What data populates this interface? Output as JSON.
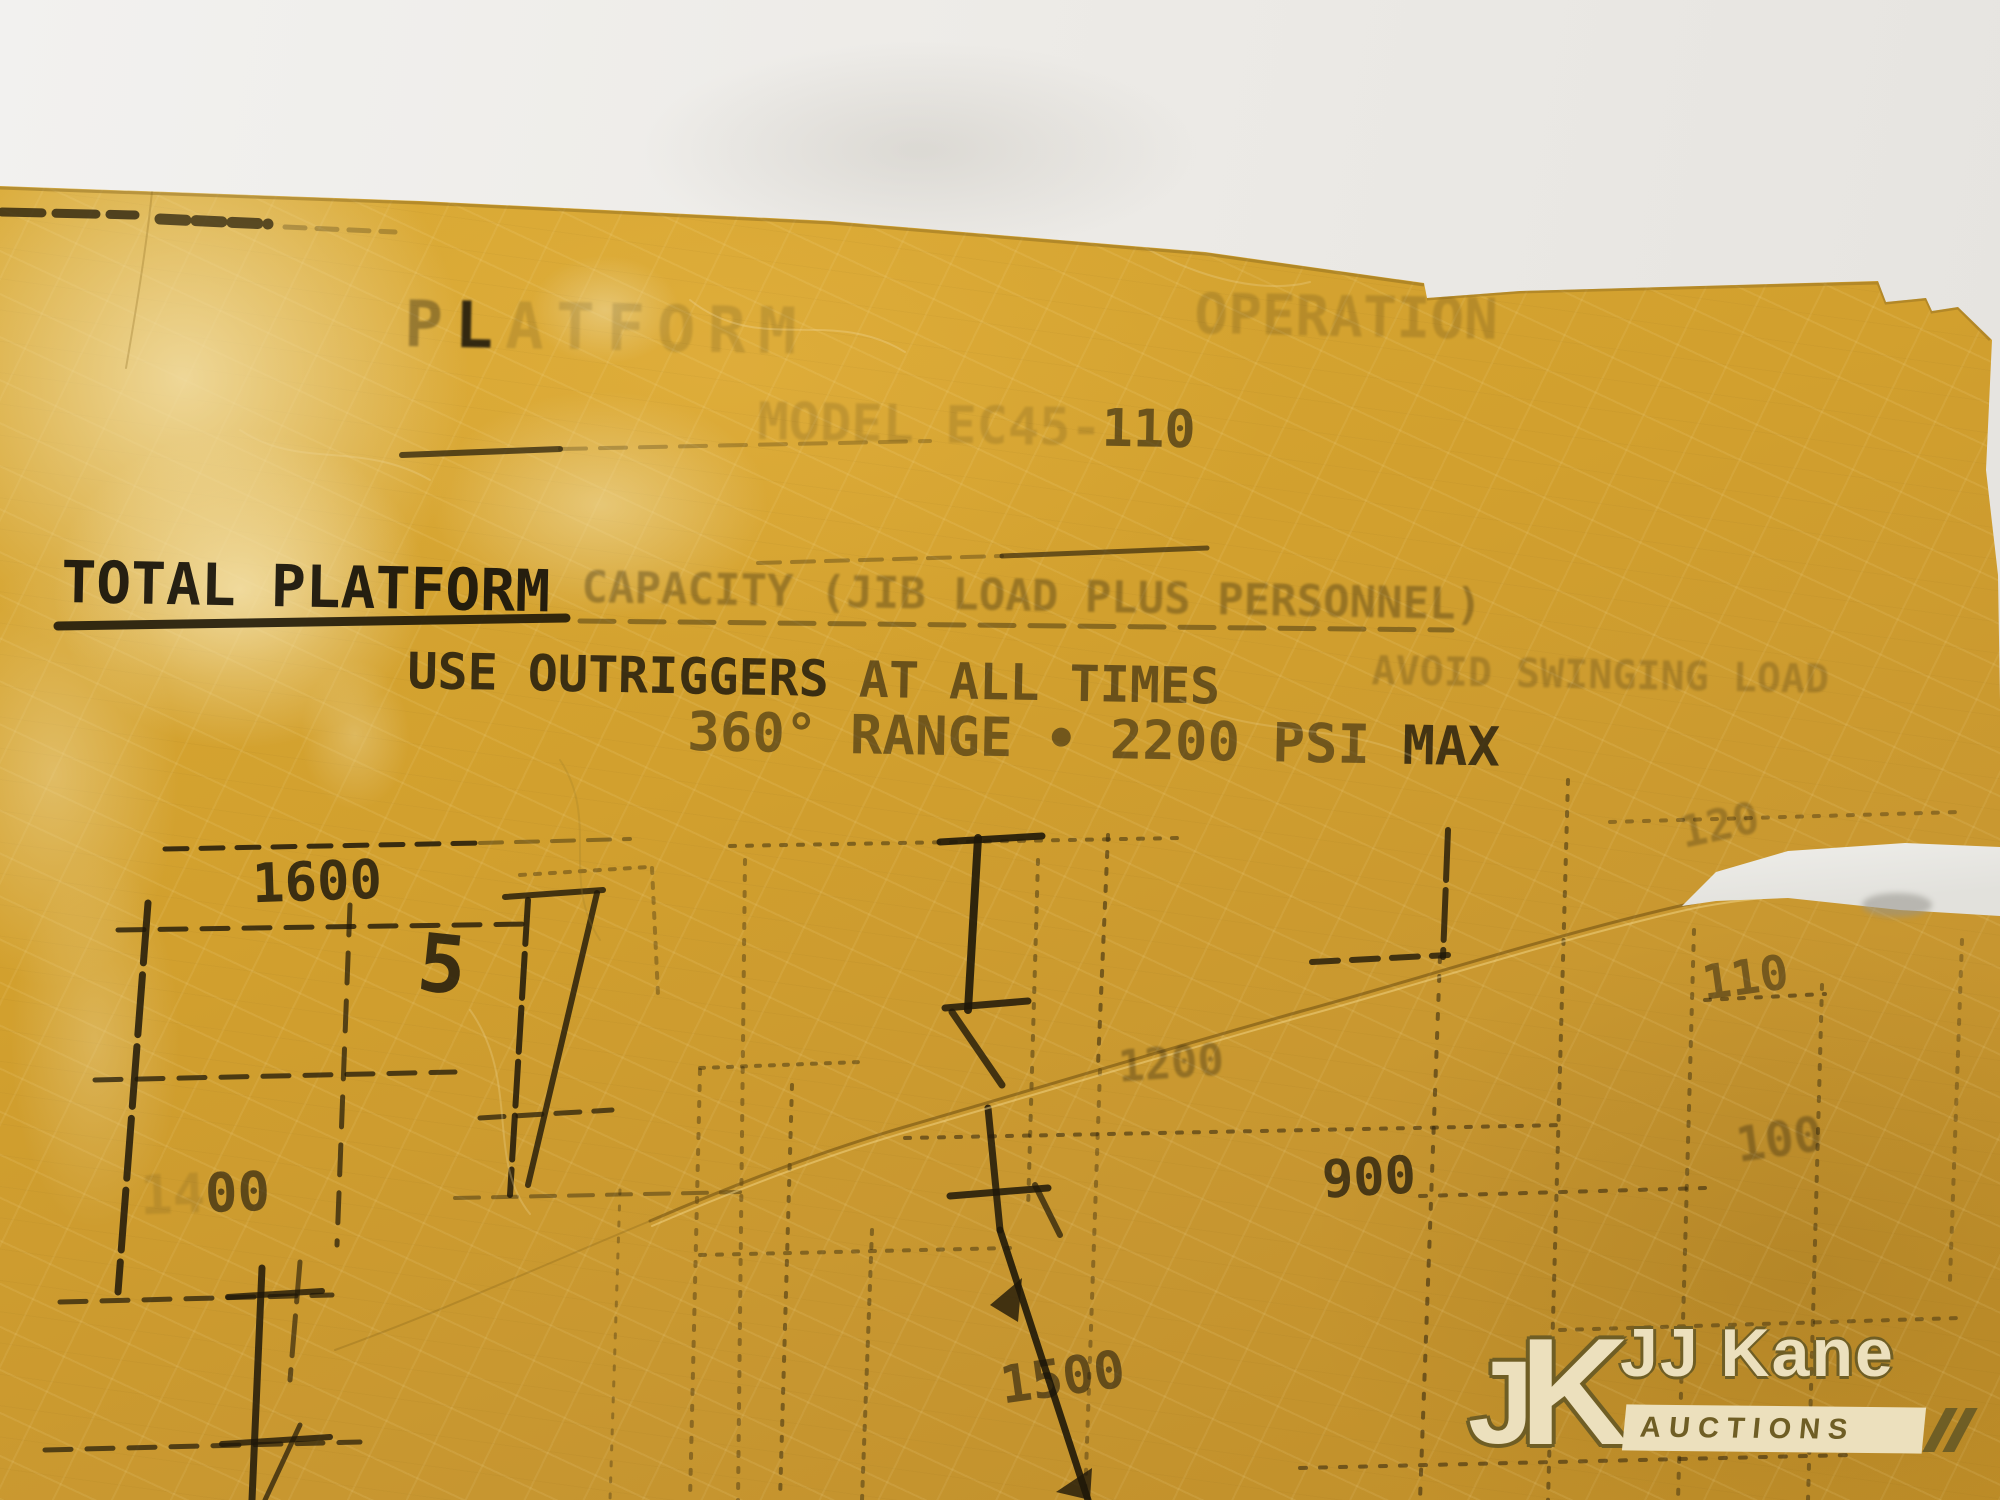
{
  "colors": {
    "placard_yellow": "#d2a02e",
    "wall_white": "#edebe7",
    "ink_black": "#16120a",
    "watermark_cream": "#ece0bd",
    "watermark_olive": "#6f5e25"
  },
  "placard": {
    "ghost_title": {
      "p": "P",
      "l": "L",
      "rest": "ATFORM",
      "right": "OPERATION"
    },
    "model_line": {
      "ghost": "MODEL EC45-",
      "dark": "110"
    },
    "capacity_line": {
      "strong": "TOTAL PLATFORM",
      "faded": "CAPACITY (JIB LOAD PLUS PERSONNEL)"
    },
    "outriggers_line": {
      "dark": "USE OUTRIGGERS",
      "mid": "AT ALL TIMES",
      "faded": "AVOID SWINGING LOAD"
    },
    "pressure_line": {
      "main": "360° RANGE • 2200 PSI",
      "dark": "MAX"
    },
    "chart_labels": {
      "left_top": "1600",
      "left_mid_prefix": "14",
      "left_mid": "00",
      "mid_upper": "1200",
      "mid_right": "900",
      "mid_lower": "1500",
      "right_top": "120",
      "right_mid": "110",
      "right_low": "100",
      "boom_digit": "5"
    }
  },
  "watermark": {
    "monogram_j": "J",
    "monogram_k": "K",
    "name": "JJ Kane",
    "tagline": "AUCTIONS"
  }
}
